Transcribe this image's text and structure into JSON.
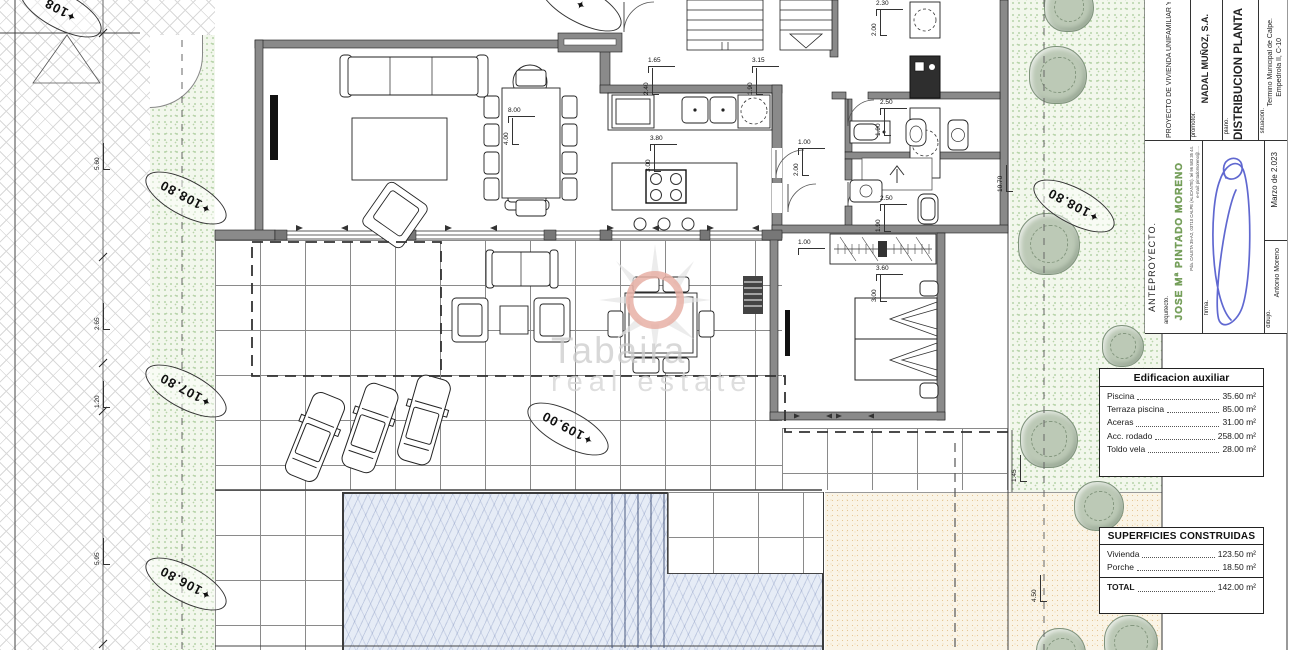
{
  "watermark": {
    "line1": "Tabaira",
    "line2": "real estate"
  },
  "elevations": {
    "road_top": "108",
    "left_upper": "108.80",
    "left_mid": "107.80",
    "left_lower": "106.80",
    "terrace": "109.00",
    "right_garden": "108.80",
    "star": "✦"
  },
  "dims": {
    "kitchen_w": "1.65",
    "kitchen_h": "2.40",
    "pantry_w": "3.15",
    "pantry_h": "1.90",
    "island_w": "3.80",
    "island_h": "3.00",
    "hall_w": "1.00",
    "hall_h": "2.00",
    "laundry_w": "2.30",
    "laundry_h": "2.00",
    "bath1_w": "2.50",
    "bath1_h": "1.90",
    "bath2_w": "2.50",
    "bath2_h": "1.90",
    "bed_w": "3.60",
    "bed_h": "3.00",
    "ward": "1.00",
    "dining_w": "8.00",
    "dining_h": "4.00",
    "left_1": "5.60",
    "left_2": "2.65",
    "left_3": "1.20",
    "left_4": "5.95",
    "right_wall": "10.70",
    "right_off": "1.45",
    "sand": "4.50"
  },
  "tables": {
    "aux": {
      "title": "Edificacion auxiliar",
      "rows": [
        {
          "label": "Piscina",
          "value": "35.60 m²"
        },
        {
          "label": "Terraza piscina",
          "value": "85.00 m²"
        },
        {
          "label": "Aceras",
          "value": "31.00 m²"
        },
        {
          "label": "Acc. rodado",
          "value": "258.00 m²"
        },
        {
          "label": "Toldo vela",
          "value": "28.00 m²"
        }
      ]
    },
    "built": {
      "title": "SUPERFICIES CONSTRUIDAS",
      "rows": [
        {
          "label": "Vivienda",
          "value": "123.50 m²"
        },
        {
          "label": "Porche",
          "value": "18.50 m²"
        }
      ],
      "total_label": "TOTAL",
      "total_value": "142.00 m²"
    }
  },
  "titleblock": {
    "stage": "ANTEPROYECTO.",
    "architect_label": "arquitecto.",
    "architect": "JOSE Mª PINTADO MORENO",
    "address": "Pda. CALETA 35-A2, 03710 CALPE (ALICANTE). tel 96 583 35 44.",
    "email": "e-mail: pintadomoreno@.....",
    "signature_label": "firma.",
    "date": "Marzo de 2.023",
    "drawer_label": "dibujo.",
    "drawer": "Antonio Moreno",
    "project": "PROYECTO DE VIVIENDA UNIFAMILIAR Y P",
    "promoter_label": "promotor.",
    "promoter": "NADAL MUÑOZ, S.A.",
    "plan_label": "plano.",
    "plan": "DISTRIBUCION PLANTA",
    "location_label": "situación.",
    "location1": "Termino Municipal de Calpe.",
    "location2": "Empedrola II, C-10"
  },
  "colors": {
    "wall": "#8a8a8a",
    "garden_dot": "#9cc48c",
    "pool": "#e6ecf6",
    "sand": "#faf4e6",
    "signature": "#4f58cc",
    "watermark_ring": "#e8b0a6",
    "architect_green": "#7aa45e"
  }
}
